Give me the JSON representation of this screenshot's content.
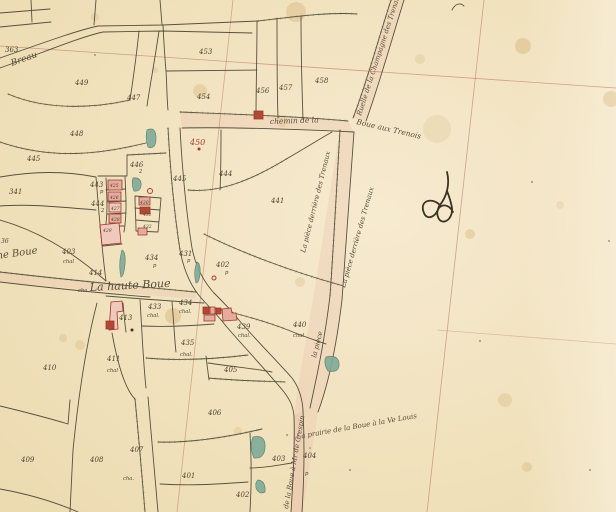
{
  "map": {
    "colors": {
      "paper": "#f1e2bd",
      "paper_light": "#f7ecd4",
      "ink": "#4a4434",
      "text_ink": "#4d4433",
      "hatch_green": "#6f7f57",
      "grid_red": "#b2584a",
      "red_ink": "#a83a2c",
      "building_pink": "#e3ac9e",
      "building_light": "#eec9bc",
      "building_dark": "#b04a37",
      "teal": "#7fab99",
      "teal_dark": "#527d6a",
      "road_tint": "#e8c2ac"
    },
    "parcel_numbers": [
      {
        "n": "363",
        "x": 5,
        "y": 52
      },
      {
        "n": "449",
        "x": 75,
        "y": 85
      },
      {
        "n": "447",
        "x": 127,
        "y": 100
      },
      {
        "n": "448",
        "x": 70,
        "y": 136
      },
      {
        "n": "445",
        "x": 27,
        "y": 161
      },
      {
        "n": "341",
        "x": 9,
        "y": 194
      },
      {
        "n": "453",
        "x": 199,
        "y": 54
      },
      {
        "n": "454",
        "x": 197,
        "y": 99
      },
      {
        "n": "456",
        "x": 256,
        "y": 93
      },
      {
        "n": "457",
        "x": 279,
        "y": 90
      },
      {
        "n": "458",
        "x": 315,
        "y": 83
      },
      {
        "n": "446",
        "x": 130,
        "y": 167
      },
      {
        "n": "445",
        "x": 173,
        "y": 181
      },
      {
        "n": "444",
        "x": 219,
        "y": 176
      },
      {
        "n": "441",
        "x": 271,
        "y": 203
      },
      {
        "n": "443",
        "x": 90,
        "y": 187
      },
      {
        "n": "444",
        "x": 91,
        "y": 206
      },
      {
        "n": "425",
        "x": 110,
        "y": 187,
        "s": 4.5
      },
      {
        "n": "426",
        "x": 110,
        "y": 199,
        "s": 4.5
      },
      {
        "n": "427",
        "x": 111,
        "y": 210,
        "s": 4.5
      },
      {
        "n": "428",
        "x": 111,
        "y": 221,
        "s": 4.5
      },
      {
        "n": "429",
        "x": 103,
        "y": 232,
        "s": 4.5
      },
      {
        "n": "430",
        "x": 140,
        "y": 204,
        "s": 4.5
      },
      {
        "n": "431",
        "x": 143,
        "y": 216,
        "s": 4.5
      },
      {
        "n": "432",
        "x": 143,
        "y": 228,
        "s": 4.5
      },
      {
        "n": "433",
        "x": 148,
        "y": 309
      },
      {
        "n": "434",
        "x": 179,
        "y": 305
      },
      {
        "n": "434",
        "x": 145,
        "y": 260
      },
      {
        "n": "431",
        "x": 179,
        "y": 256
      },
      {
        "n": "402",
        "x": 216,
        "y": 267
      },
      {
        "n": "439",
        "x": 237,
        "y": 329
      },
      {
        "n": "435",
        "x": 181,
        "y": 345
      },
      {
        "n": "440",
        "x": 293,
        "y": 327
      },
      {
        "n": "405",
        "x": 224,
        "y": 372
      },
      {
        "n": "406",
        "x": 208,
        "y": 415
      },
      {
        "n": "401",
        "x": 182,
        "y": 478
      },
      {
        "n": "402",
        "x": 236,
        "y": 497
      },
      {
        "n": "403",
        "x": 272,
        "y": 461
      },
      {
        "n": "404",
        "x": 303,
        "y": 458
      },
      {
        "n": "407",
        "x": 130,
        "y": 452
      },
      {
        "n": "408",
        "x": 90,
        "y": 462
      },
      {
        "n": "409",
        "x": 21,
        "y": 462
      },
      {
        "n": "410",
        "x": 43,
        "y": 370
      },
      {
        "n": "411",
        "x": 107,
        "y": 361
      },
      {
        "n": "413",
        "x": 119,
        "y": 320
      },
      {
        "n": "414",
        "x": 89,
        "y": 275
      },
      {
        "n": "403",
        "x": 62,
        "y": 254
      },
      {
        "n": "36",
        "x": 1,
        "y": 243,
        "s": 6
      }
    ],
    "sub_labels": [
      {
        "t": "chal.",
        "x": 147,
        "y": 317
      },
      {
        "t": "chal.",
        "x": 179,
        "y": 313
      },
      {
        "t": "chal.",
        "x": 238,
        "y": 337
      },
      {
        "t": "chal.",
        "x": 180,
        "y": 356
      },
      {
        "t": "chal",
        "x": 293,
        "y": 337
      },
      {
        "t": "chal",
        "x": 107,
        "y": 372
      },
      {
        "t": "chal",
        "x": 63,
        "y": 263
      },
      {
        "t": "cha.",
        "x": 123,
        "y": 480
      },
      {
        "t": "cha.",
        "x": 78,
        "y": 292
      },
      {
        "t": "p",
        "x": 100,
        "y": 193
      },
      {
        "t": "2",
        "x": 101,
        "y": 212
      },
      {
        "t": "2",
        "x": 139,
        "y": 173
      },
      {
        "t": "p",
        "x": 153,
        "y": 267
      },
      {
        "t": "p",
        "x": 187,
        "y": 262
      },
      {
        "t": "p",
        "x": 225,
        "y": 274
      },
      {
        "t": "p",
        "x": 305,
        "y": 475
      }
    ],
    "place_names": [
      {
        "t": "Breau",
        "x": 12,
        "y": 66,
        "r": -20,
        "s": 9
      },
      {
        "t": "chemin  de  la",
        "x": 270,
        "y": 124,
        "r": -2,
        "s": 7.5
      },
      {
        "t": "Boue  aux  Trenois",
        "x": 356,
        "y": 124,
        "r": 13,
        "s": 7.5
      },
      {
        "t": "Ruelle de la Champagne des Trenaux",
        "x": 361,
        "y": 116,
        "r": -72,
        "s": 6.8
      },
      {
        "t": "La pièce derrière des Trenaux",
        "x": 305,
        "y": 253,
        "r": -76,
        "s": 6.8
      },
      {
        "t": "La pièce derrière des Trenaux",
        "x": 345,
        "y": 288,
        "r": -74,
        "s": 6.8
      },
      {
        "t": "la pièce",
        "x": 316,
        "y": 358,
        "r": -76,
        "s": 6.8
      },
      {
        "t": "La   haute   Boue",
        "x": 90,
        "y": 291,
        "r": -3,
        "s": 11
      },
      {
        "t": "ne  Boue",
        "x": -3,
        "y": 259,
        "r": -8,
        "s": 10
      },
      {
        "t": "La  prairie  de  la  Boue  à  la  Ve  Louis",
        "x": 297,
        "y": 439,
        "r": -10,
        "s": 7
      },
      {
        "t": "de la Boue à Mr de Crespin",
        "x": 288,
        "y": 509,
        "r": -80,
        "s": 6.8
      }
    ],
    "red_annotations": [
      {
        "t": "450",
        "x": 190,
        "y": 145,
        "s": 8
      },
      {
        "t": "537",
        "x": 204,
        "y": 314,
        "s": 3.5
      }
    ]
  }
}
